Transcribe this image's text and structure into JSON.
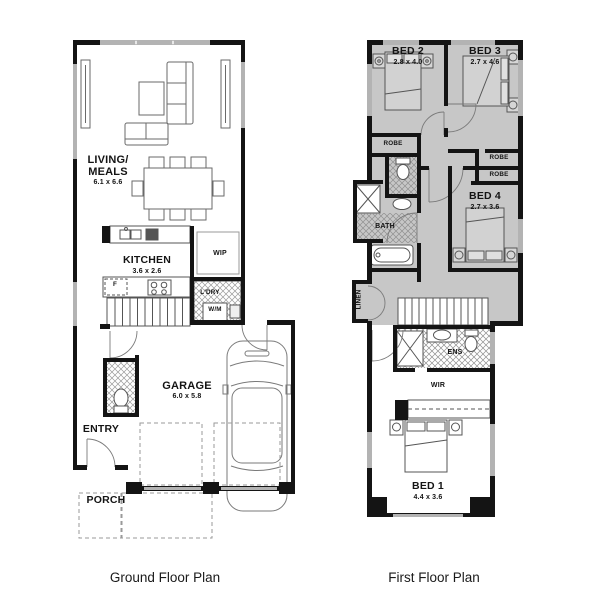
{
  "captions": {
    "ground": "Ground Floor Plan",
    "first": "First Floor Plan"
  },
  "ground_floor": {
    "living_meals": {
      "name": "LIVING/\nMEALS",
      "dims": "6.1 x 6.6"
    },
    "kitchen": {
      "name": "KITCHEN",
      "dims": "3.6 x 2.6"
    },
    "wip": {
      "name": "WIP"
    },
    "fridge": {
      "name": "F"
    },
    "laundry": {
      "name": "L'DRY"
    },
    "washing_machine": {
      "name": "W/M"
    },
    "garage": {
      "name": "GARAGE",
      "dims": "6.0 x 5.8"
    },
    "entry": {
      "name": "ENTRY"
    },
    "porch": {
      "name": "PORCH"
    }
  },
  "first_floor": {
    "bed1": {
      "name": "BED 1",
      "dims": "4.4 x 3.6"
    },
    "bed2": {
      "name": "BED 2",
      "dims": "2.8 x 4.0"
    },
    "bed3": {
      "name": "BED 3",
      "dims": "2.7 x 4.6"
    },
    "bed4": {
      "name": "BED 4",
      "dims": "2.7 x 3.6"
    },
    "robe_bed2": {
      "name": "ROBE"
    },
    "robe_bed3": {
      "name": "ROBE"
    },
    "robe_bed4": {
      "name": "ROBE"
    },
    "bath": {
      "name": "BATH"
    },
    "ens": {
      "name": "ENS"
    },
    "wir": {
      "name": "WIR"
    },
    "linen": {
      "name": "LINEN"
    }
  },
  "colors": {
    "wall": "#141414",
    "window": "#b3b3b3",
    "upper_floor_fill": "#c7c7c7",
    "line": "#5a5a5a"
  }
}
